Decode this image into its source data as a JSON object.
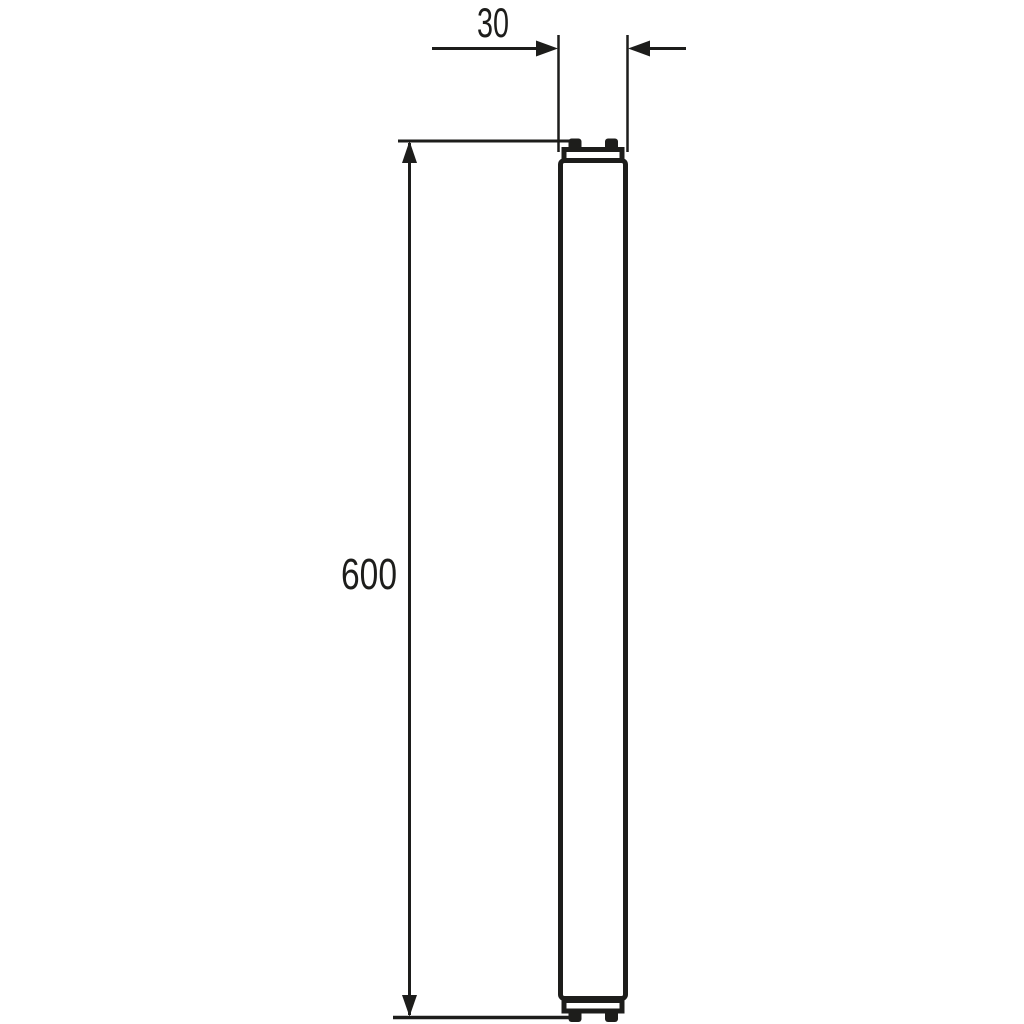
{
  "diagram": {
    "subject": "led-tube-lamp-side-profile-technical-drawing",
    "background_color": "#ffffff",
    "line_color": "#1d1d1b",
    "dimensions": {
      "width_label": "30",
      "length_label": "600"
    }
  }
}
